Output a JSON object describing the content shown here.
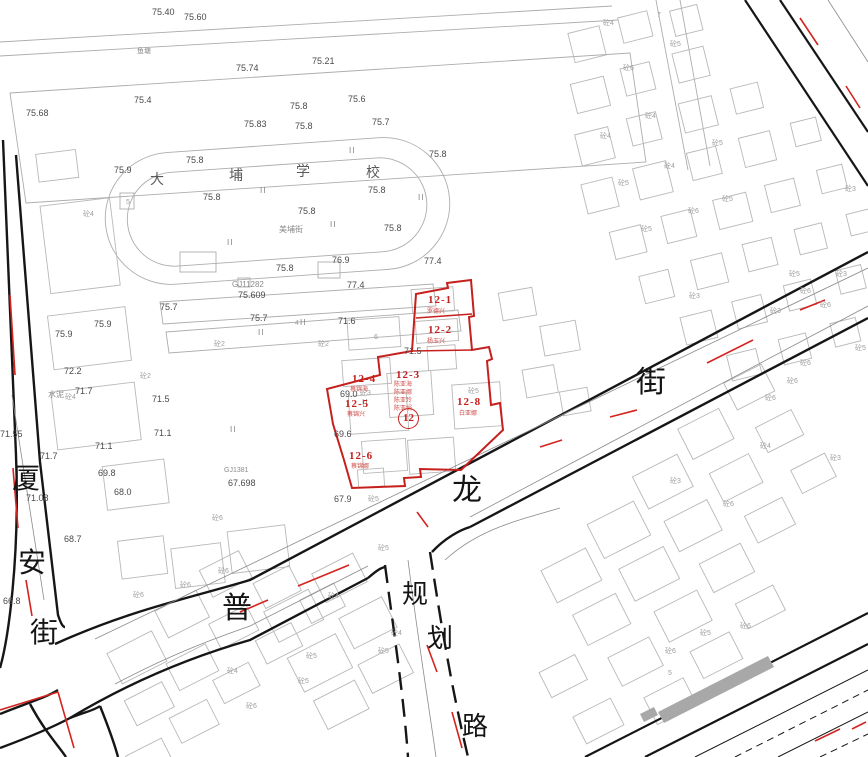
{
  "map": {
    "type": "cadastral-planning-map",
    "colors": {
      "background": "#ffffff",
      "road_black": "#161616",
      "building_gray": "#b8b8b8",
      "parcel_red": "#c5201d",
      "centerline_red": "#d42420",
      "shaded_gray": "#a8a8a8"
    },
    "streets": {
      "left_vertical": "厦安街",
      "bottom": "普",
      "main": "龙街",
      "planned_vertical": "规划路"
    },
    "school_name": "大埔学校",
    "parcel": {
      "number": "12",
      "subparcels": [
        {
          "id": "12-1",
          "owner": "罗德兴"
        },
        {
          "id": "12-2",
          "owner": "杨玉兴"
        },
        {
          "id": "12-3",
          "owners": [
            "陈亚海",
            "陈亚娜",
            "陈亚玲",
            "陈亚娟"
          ]
        },
        {
          "id": "12-4",
          "owner": "蔡锦海"
        },
        {
          "id": "12-5",
          "owner": "蔡锦兴"
        },
        {
          "id": "12-6",
          "owner": "蔡锦娜"
        },
        {
          "id": "12-8",
          "owner": "白亚娜"
        }
      ]
    },
    "labels": [
      {
        "t": "厦",
        "x": 12,
        "y": 466,
        "c": "s"
      },
      {
        "t": "安",
        "x": 18,
        "y": 550,
        "c": "s"
      },
      {
        "t": "街",
        "x": 30,
        "y": 620,
        "c": "s"
      },
      {
        "t": "普",
        "x": 222,
        "y": 594,
        "c": "s",
        "fs": 30
      },
      {
        "t": "龙",
        "x": 452,
        "y": 476,
        "c": "s",
        "fs": 30
      },
      {
        "t": "街",
        "x": 636,
        "y": 368,
        "c": "s",
        "fs": 30
      },
      {
        "t": "规",
        "x": 402,
        "y": 582,
        "c": "s",
        "fs": 26
      },
      {
        "t": "划",
        "x": 427,
        "y": 626,
        "c": "s",
        "fs": 26
      },
      {
        "t": "路",
        "x": 462,
        "y": 714,
        "c": "s",
        "fs": 26
      },
      {
        "t": "大",
        "x": 150,
        "y": 174,
        "c": "sc"
      },
      {
        "t": "埔",
        "x": 229,
        "y": 170,
        "c": "sc"
      },
      {
        "t": "学",
        "x": 296,
        "y": 166,
        "c": "sc"
      },
      {
        "t": "校",
        "x": 366,
        "y": 167,
        "c": "sc"
      },
      {
        "t": "美埔街",
        "x": 279,
        "y": 226,
        "c": "t",
        "fs": 8
      },
      {
        "t": "鱼塘",
        "x": 137,
        "y": 48,
        "c": "t"
      },
      {
        "t": "水泥",
        "x": 48,
        "y": 391,
        "c": "t",
        "fs": 8
      },
      {
        "t": "75.40",
        "x": 152,
        "y": 8,
        "c": "e"
      },
      {
        "t": "75.60",
        "x": 184,
        "y": 13,
        "c": "e"
      },
      {
        "t": "75.74",
        "x": 236,
        "y": 64,
        "c": "e"
      },
      {
        "t": "75.21",
        "x": 312,
        "y": 57,
        "c": "e"
      },
      {
        "t": "75.4",
        "x": 134,
        "y": 96,
        "c": "e"
      },
      {
        "t": "75.68",
        "x": 26,
        "y": 109,
        "c": "e"
      },
      {
        "t": "75.6",
        "x": 348,
        "y": 95,
        "c": "e"
      },
      {
        "t": "75.8",
        "x": 290,
        "y": 102,
        "c": "e"
      },
      {
        "t": "75.83",
        "x": 244,
        "y": 120,
        "c": "e"
      },
      {
        "t": "75.8",
        "x": 295,
        "y": 122,
        "c": "e"
      },
      {
        "t": "75.7",
        "x": 372,
        "y": 118,
        "c": "e"
      },
      {
        "t": "75.9",
        "x": 114,
        "y": 166,
        "c": "e"
      },
      {
        "t": "75.8",
        "x": 186,
        "y": 156,
        "c": "e"
      },
      {
        "t": "75.8",
        "x": 203,
        "y": 193,
        "c": "e"
      },
      {
        "t": "75.8",
        "x": 298,
        "y": 207,
        "c": "e"
      },
      {
        "t": "75.8",
        "x": 368,
        "y": 186,
        "c": "e"
      },
      {
        "t": "75.8",
        "x": 429,
        "y": 150,
        "c": "e"
      },
      {
        "t": "75.8",
        "x": 384,
        "y": 224,
        "c": "e"
      },
      {
        "t": "75.8",
        "x": 276,
        "y": 264,
        "c": "e"
      },
      {
        "t": "76.9",
        "x": 332,
        "y": 256,
        "c": "e"
      },
      {
        "t": "77.4",
        "x": 424,
        "y": 257,
        "c": "e"
      },
      {
        "t": "77.4",
        "x": 347,
        "y": 281,
        "c": "e"
      },
      {
        "t": "75.7",
        "x": 160,
        "y": 303,
        "c": "e"
      },
      {
        "t": "75.9",
        "x": 94,
        "y": 320,
        "c": "e"
      },
      {
        "t": "75.9",
        "x": 55,
        "y": 330,
        "c": "e"
      },
      {
        "t": "75.7",
        "x": 250,
        "y": 314,
        "c": "e"
      },
      {
        "t": "71.6",
        "x": 338,
        "y": 317,
        "c": "e"
      },
      {
        "t": "71.5",
        "x": 404,
        "y": 347,
        "c": "e"
      },
      {
        "t": "72.2",
        "x": 64,
        "y": 367,
        "c": "e"
      },
      {
        "t": "71.7",
        "x": 75,
        "y": 387,
        "c": "e"
      },
      {
        "t": "71.5",
        "x": 152,
        "y": 395,
        "c": "e"
      },
      {
        "t": "71.1",
        "x": 154,
        "y": 429,
        "c": "e"
      },
      {
        "t": "71.1",
        "x": 95,
        "y": 442,
        "c": "e"
      },
      {
        "t": "71.55",
        "x": 0,
        "y": 430,
        "c": "e"
      },
      {
        "t": "69.0",
        "x": 340,
        "y": 390,
        "c": "e"
      },
      {
        "t": "69.6",
        "x": 334,
        "y": 430,
        "c": "e"
      },
      {
        "t": "68.0",
        "x": 114,
        "y": 488,
        "c": "e"
      },
      {
        "t": "69.8",
        "x": 98,
        "y": 469,
        "c": "e"
      },
      {
        "t": "71.7",
        "x": 40,
        "y": 452,
        "c": "e"
      },
      {
        "t": "68.7",
        "x": 64,
        "y": 535,
        "c": "e"
      },
      {
        "t": "66.8",
        "x": 3,
        "y": 597,
        "c": "e"
      },
      {
        "t": "71.08",
        "x": 26,
        "y": 494,
        "c": "e"
      },
      {
        "t": "67.9",
        "x": 334,
        "y": 495,
        "c": "e"
      },
      {
        "t": "67.698",
        "x": 228,
        "y": 479,
        "c": "e"
      },
      {
        "t": "75.609",
        "x": 238,
        "y": 291,
        "c": "e"
      },
      {
        "t": "GJ11282",
        "x": 232,
        "y": 281,
        "c": "t",
        "fs": 8
      },
      {
        "t": "GJ1381",
        "x": 224,
        "y": 467,
        "c": "t"
      },
      {
        "t": "II",
        "x": 349,
        "y": 147,
        "c": "m"
      },
      {
        "t": "II",
        "x": 260,
        "y": 187,
        "c": "m"
      },
      {
        "t": "II",
        "x": 418,
        "y": 194,
        "c": "m"
      },
      {
        "t": "II",
        "x": 330,
        "y": 221,
        "c": "m"
      },
      {
        "t": "II",
        "x": 227,
        "y": 239,
        "c": "m"
      },
      {
        "t": "II",
        "x": 300,
        "y": 319,
        "c": "m"
      },
      {
        "t": "II",
        "x": 258,
        "y": 329,
        "c": "m"
      },
      {
        "t": "II",
        "x": 362,
        "y": 399,
        "c": "m"
      },
      {
        "t": "II",
        "x": 230,
        "y": 426,
        "c": "m"
      },
      {
        "t": "12-1",
        "x": 428,
        "y": 295,
        "c": "r"
      },
      {
        "t": "12-2",
        "x": 428,
        "y": 325,
        "c": "r"
      },
      {
        "t": "12-3",
        "x": 396,
        "y": 370,
        "c": "r"
      },
      {
        "t": "12-4",
        "x": 352,
        "y": 374,
        "c": "r"
      },
      {
        "t": "12-5",
        "x": 345,
        "y": 399,
        "c": "r"
      },
      {
        "t": "12-6",
        "x": 349,
        "y": 451,
        "c": "r"
      },
      {
        "t": "12-8",
        "x": 457,
        "y": 397,
        "c": "r"
      },
      {
        "t": "12",
        "x": 398,
        "y": 408,
        "c": "rc"
      },
      {
        "t": "罗德兴",
        "x": 427,
        "y": 309,
        "c": "rs"
      },
      {
        "t": "杨玉兴",
        "x": 427,
        "y": 339,
        "c": "rs"
      },
      {
        "t": "陈亚海",
        "x": 394,
        "y": 382,
        "c": "rs"
      },
      {
        "t": "陈亚娜",
        "x": 394,
        "y": 390,
        "c": "rs"
      },
      {
        "t": "陈亚玲",
        "x": 394,
        "y": 398,
        "c": "rs"
      },
      {
        "t": "陈亚娟",
        "x": 394,
        "y": 406,
        "c": "rs"
      },
      {
        "t": "蔡锦海",
        "x": 350,
        "y": 387,
        "c": "rs"
      },
      {
        "t": "蔡锦兴",
        "x": 347,
        "y": 412,
        "c": "rs"
      },
      {
        "t": "蔡锦娜",
        "x": 351,
        "y": 464,
        "c": "rs"
      },
      {
        "t": "白亚娜",
        "x": 459,
        "y": 411,
        "c": "rs"
      },
      {
        "t": "砼4",
        "x": 603,
        "y": 20,
        "c": "b"
      },
      {
        "t": "7",
        "x": 657,
        "y": 12,
        "c": "b"
      },
      {
        "t": "砼5",
        "x": 670,
        "y": 41,
        "c": "b"
      },
      {
        "t": "砼6",
        "x": 623,
        "y": 65,
        "c": "b"
      },
      {
        "t": "砼4",
        "x": 645,
        "y": 113,
        "c": "b"
      },
      {
        "t": "砼4",
        "x": 600,
        "y": 133,
        "c": "b"
      },
      {
        "t": "砼5",
        "x": 712,
        "y": 140,
        "c": "b"
      },
      {
        "t": "砼4",
        "x": 664,
        "y": 163,
        "c": "b"
      },
      {
        "t": "砼5",
        "x": 618,
        "y": 180,
        "c": "b"
      },
      {
        "t": "砼6",
        "x": 688,
        "y": 208,
        "c": "b"
      },
      {
        "t": "砼5",
        "x": 641,
        "y": 226,
        "c": "b"
      },
      {
        "t": "砼5",
        "x": 722,
        "y": 196,
        "c": "b"
      },
      {
        "t": "砼3",
        "x": 845,
        "y": 186,
        "c": "b"
      },
      {
        "t": "砼3",
        "x": 836,
        "y": 271,
        "c": "b"
      },
      {
        "t": "砼5",
        "x": 789,
        "y": 271,
        "c": "b"
      },
      {
        "t": "砼6",
        "x": 800,
        "y": 288,
        "c": "b"
      },
      {
        "t": "砼3",
        "x": 689,
        "y": 293,
        "c": "b"
      },
      {
        "t": "砼3",
        "x": 770,
        "y": 308,
        "c": "b"
      },
      {
        "t": "砼6",
        "x": 820,
        "y": 302,
        "c": "b"
      },
      {
        "t": "砼5",
        "x": 855,
        "y": 345,
        "c": "b"
      },
      {
        "t": "砼6",
        "x": 800,
        "y": 360,
        "c": "b"
      },
      {
        "t": "砼6",
        "x": 787,
        "y": 378,
        "c": "b"
      },
      {
        "t": "砼6",
        "x": 765,
        "y": 395,
        "c": "b"
      },
      {
        "t": "砼3",
        "x": 830,
        "y": 455,
        "c": "b"
      },
      {
        "t": "砼6",
        "x": 723,
        "y": 501,
        "c": "b"
      },
      {
        "t": "砼3",
        "x": 670,
        "y": 478,
        "c": "b"
      },
      {
        "t": "砼4",
        "x": 760,
        "y": 443,
        "c": "b"
      },
      {
        "t": "砼5",
        "x": 368,
        "y": 496,
        "c": "b"
      },
      {
        "t": "砼5",
        "x": 378,
        "y": 545,
        "c": "b"
      },
      {
        "t": "砼6",
        "x": 218,
        "y": 568,
        "c": "b"
      },
      {
        "t": "砼6",
        "x": 212,
        "y": 515,
        "c": "b"
      },
      {
        "t": "砼4",
        "x": 328,
        "y": 593,
        "c": "b"
      },
      {
        "t": "砼5",
        "x": 306,
        "y": 653,
        "c": "b"
      },
      {
        "t": "砼4",
        "x": 391,
        "y": 630,
        "c": "b"
      },
      {
        "t": "砼5",
        "x": 378,
        "y": 648,
        "c": "b"
      },
      {
        "t": "砼6",
        "x": 246,
        "y": 703,
        "c": "b"
      },
      {
        "t": "砼4",
        "x": 83,
        "y": 211,
        "c": "b"
      },
      {
        "t": "砼6",
        "x": 133,
        "y": 592,
        "c": "b"
      },
      {
        "t": "砼6",
        "x": 180,
        "y": 582,
        "c": "b"
      },
      {
        "t": "砼4",
        "x": 227,
        "y": 668,
        "c": "b"
      },
      {
        "t": "砼5",
        "x": 298,
        "y": 678,
        "c": "b"
      },
      {
        "t": "砼2",
        "x": 214,
        "y": 341,
        "c": "b"
      },
      {
        "t": "砼2",
        "x": 318,
        "y": 341,
        "c": "b"
      },
      {
        "t": "砼2",
        "x": 140,
        "y": 373,
        "c": "b"
      },
      {
        "t": "砼4",
        "x": 65,
        "y": 394,
        "c": "b"
      },
      {
        "t": "砼3",
        "x": 360,
        "y": 390,
        "c": "b"
      },
      {
        "t": "砼5",
        "x": 468,
        "y": 388,
        "c": "b"
      },
      {
        "t": "砼6",
        "x": 740,
        "y": 623,
        "c": "b"
      },
      {
        "t": "砼5",
        "x": 700,
        "y": 630,
        "c": "b"
      },
      {
        "t": "砼6",
        "x": 665,
        "y": 648,
        "c": "b"
      },
      {
        "t": "5",
        "x": 668,
        "y": 670,
        "c": "b"
      },
      {
        "t": "5",
        "x": 126,
        "y": 199,
        "c": "b"
      },
      {
        "t": "6",
        "x": 374,
        "y": 334,
        "c": "b"
      },
      {
        "t": "4",
        "x": 295,
        "y": 320,
        "c": "b"
      }
    ]
  }
}
